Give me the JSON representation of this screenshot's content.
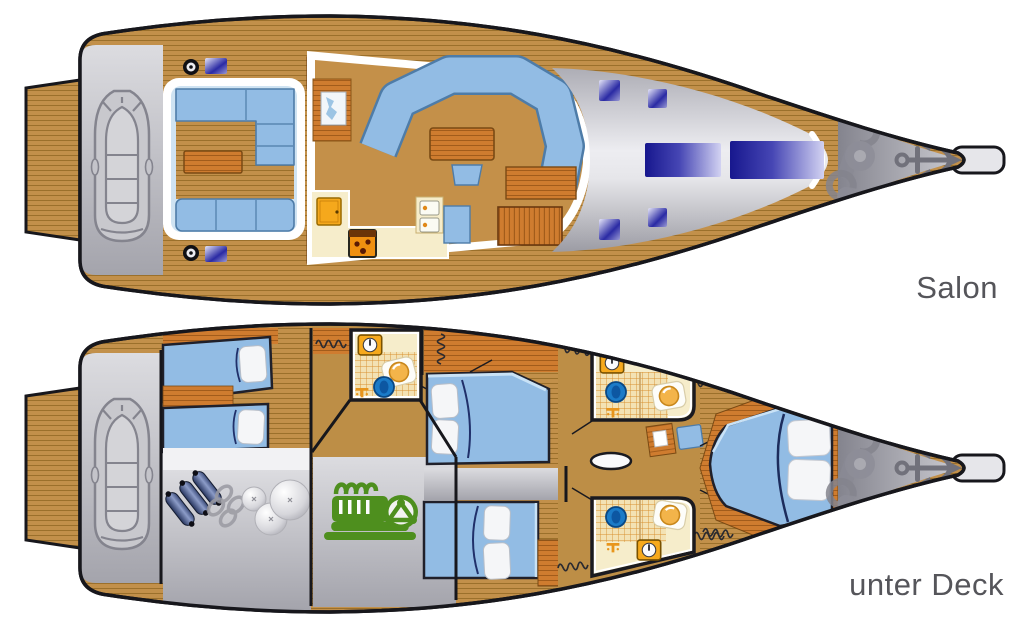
{
  "decks": [
    {
      "id": "salon",
      "label": "Salon",
      "features": [
        "swim-platform",
        "dinghy",
        "cockpit-seating",
        "cockpit-table",
        "winches",
        "salon-sofa",
        "salon-table",
        "nav-station",
        "galley",
        "stove",
        "fridge",
        "companionway-steps",
        "deck-hatches",
        "anchor-windlass",
        "anchor"
      ]
    },
    {
      "id": "unter-deck",
      "label": "unter Deck",
      "features": [
        "swim-platform",
        "dinghy",
        "aft-cabin-two-berths",
        "storage-fenders-chain",
        "engine-room",
        "wc-shower-aft",
        "wc-shower-fore-port",
        "wc-shower-fore-starboard",
        "double-cabin-port",
        "double-cabin-starboard",
        "owner-cabin-v-berth",
        "wardrobes",
        "chain-locker",
        "anchor-windlass",
        "anchor"
      ]
    }
  ],
  "palette": {
    "deck_wood": "#C2904A",
    "furniture_wood": "#CF7C2F",
    "upholstery_blue": "#92BCE4",
    "hatch_navy": "#17178E",
    "gray": "#ACACB4",
    "cream": "#F6EDCB",
    "appliance_orange": "#F6A91D",
    "engine_green": "#4E8F1E",
    "toilet_blue": "#1B7BC8",
    "label_text": "#55555A"
  }
}
